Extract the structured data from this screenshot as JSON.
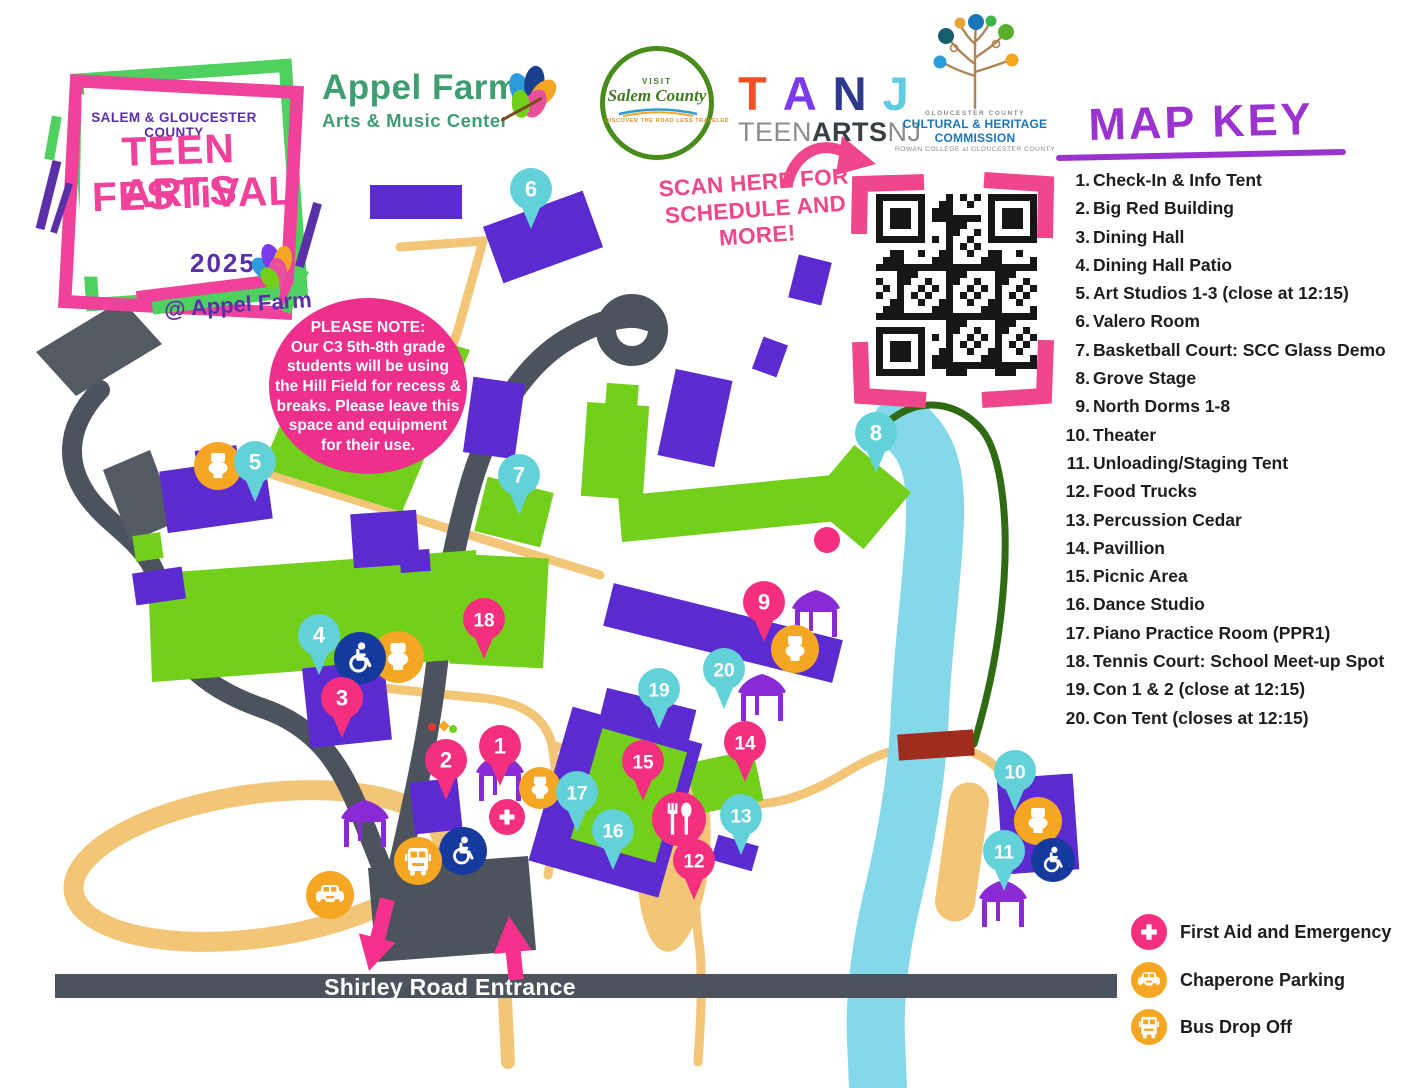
{
  "festival_logo": {
    "county_line": "SALEM & GLOUCESTER  COUNTY",
    "title_line1": "TEEN ARTS",
    "title_line2": "FESTiVAL",
    "year": "2025",
    "venue": "@ Appel Farm"
  },
  "logos": {
    "appel": {
      "name": "Appel Farm",
      "sub": "Arts & Music Center"
    },
    "salem": {
      "visit": "VISIT",
      "name": "Salem County",
      "tagline": "DISCOVER THE ROAD LESS TRAVELED"
    },
    "tanj": {
      "letters": [
        {
          "ch": "T",
          "color": "#f05123"
        },
        {
          "ch": "A",
          "color": "#7c3aed"
        },
        {
          "ch": "N",
          "color": "#2d3a8c"
        },
        {
          "ch": "J",
          "color": "#62cbe0"
        }
      ],
      "sub_teen": "TEEN",
      "sub_arts": "ARTS",
      "sub_nj": "NJ"
    },
    "chc": {
      "county": "GLOUCESTER   COUNTY",
      "line1": "CULTURAL & HERITAGE",
      "line2": "COMMISSION",
      "line3": "ROWAN COLLEGE at GLOUCESTER COUNTY"
    }
  },
  "scan": {
    "line1": "SCAN HERE FOR",
    "line2": "SCHEDULE AND MORE!"
  },
  "note": {
    "lines": [
      "PLEASE NOTE:",
      "Our C3 5th-8th grade",
      "students will be using",
      "the Hill Field for recess &",
      "breaks. Please leave this",
      "space and equipment",
      "for their use."
    ]
  },
  "road_label": "Shirley Road Entrance",
  "map_key": {
    "title": "MAP KEY",
    "items": [
      {
        "num": "1.",
        "label": "Check-In & Info Tent"
      },
      {
        "num": "2.",
        "label": "Big Red Building"
      },
      {
        "num": "3.",
        "label": "Dining Hall"
      },
      {
        "num": "4.",
        "label": "Dining Hall Patio"
      },
      {
        "num": "5.",
        "label": "Art Studios 1-3 (close at 12:15)"
      },
      {
        "num": "6.",
        "label": "Valero Room"
      },
      {
        "num": "7.",
        "label": "Basketball Court: SCC Glass Demo"
      },
      {
        "num": "8.",
        "label": "Grove Stage"
      },
      {
        "num": "9.",
        "label": "North Dorms 1-8"
      },
      {
        "num": "10.",
        "label": "Theater"
      },
      {
        "num": "11.",
        "label": "Unloading/Staging Tent"
      },
      {
        "num": "12.",
        "label": "Food Trucks"
      },
      {
        "num": "13.",
        "label": "Percussion Cedar"
      },
      {
        "num": "14.",
        "label": "Pavillion"
      },
      {
        "num": "15.",
        "label": "Picnic Area"
      },
      {
        "num": "16.",
        "label": "Dance Studio"
      },
      {
        "num": "17.",
        "label": "Piano Practice Room (PPR1)"
      },
      {
        "num": "18.",
        "label": "Tennis Court: School Meet-up Spot"
      },
      {
        "num": "19.",
        "label": "Con 1 & 2 (close at 12:15)"
      },
      {
        "num": "20.",
        "label": "Con Tent (closes at 12:15)"
      }
    ]
  },
  "legend": [
    {
      "icon": "firstaid",
      "color": "#f4307e",
      "label": "First Aid and Emergency"
    },
    {
      "icon": "car",
      "color": "#f5a623",
      "label": "Chaperone Parking"
    },
    {
      "icon": "bus",
      "color": "#f5a623",
      "label": "Bus Drop Off"
    }
  ],
  "colors": {
    "purple": "#5b2ad0",
    "green": "#72d01a",
    "cyan": "#62d2d8",
    "pink": "#f4307e",
    "orange": "#f5a623",
    "navy": "#16399e",
    "tan": "#f2c577",
    "road": "#4d535c",
    "river": "#85d8e9",
    "trail": "#2e6b12",
    "bridge": "#a02c1c",
    "tent": "#8a2ad4",
    "key_purple": "#9a33cf",
    "brand_pink": "#f0419b",
    "brand_purple": "#5b2fa8",
    "appel_green": "#3f9e71",
    "scan_pink": "#f0468c"
  },
  "markers": [
    {
      "n": "1",
      "c": "pink",
      "x": 500,
      "y": 746
    },
    {
      "n": "2",
      "c": "pink",
      "x": 446,
      "y": 760
    },
    {
      "n": "3",
      "c": "pink",
      "x": 342,
      "y": 698
    },
    {
      "n": "4",
      "c": "cyan",
      "x": 319,
      "y": 635
    },
    {
      "n": "5",
      "c": "cyan",
      "x": 255,
      "y": 462
    },
    {
      "n": "6",
      "c": "cyan",
      "x": 531,
      "y": 189
    },
    {
      "n": "7",
      "c": "cyan",
      "x": 519,
      "y": 475
    },
    {
      "n": "8",
      "c": "cyan",
      "x": 876,
      "y": 433
    },
    {
      "n": "9",
      "c": "pink",
      "x": 764,
      "y": 602
    },
    {
      "n": "10",
      "c": "cyan",
      "x": 1015,
      "y": 771
    },
    {
      "n": "11",
      "c": "cyan",
      "x": 1004,
      "y": 851
    },
    {
      "n": "12",
      "c": "pink",
      "x": 694,
      "y": 860
    },
    {
      "n": "13",
      "c": "cyan",
      "x": 741,
      "y": 815
    },
    {
      "n": "14",
      "c": "pink",
      "x": 745,
      "y": 742
    },
    {
      "n": "15",
      "c": "pink",
      "x": 643,
      "y": 761
    },
    {
      "n": "16",
      "c": "cyan",
      "x": 613,
      "y": 830
    },
    {
      "n": "17",
      "c": "cyan",
      "x": 577,
      "y": 792
    },
    {
      "n": "18",
      "c": "pink",
      "x": 484,
      "y": 619
    },
    {
      "n": "19",
      "c": "cyan",
      "x": 659,
      "y": 689
    },
    {
      "n": "20",
      "c": "cyan",
      "x": 724,
      "y": 669
    }
  ],
  "amenity_icons": [
    {
      "t": "toilet",
      "x": 218,
      "y": 466,
      "r": 24
    },
    {
      "t": "toilet",
      "x": 398,
      "y": 657,
      "r": 26
    },
    {
      "t": "toilet",
      "x": 540,
      "y": 788,
      "r": 21
    },
    {
      "t": "toilet",
      "x": 795,
      "y": 649,
      "r": 24
    },
    {
      "t": "toilet",
      "x": 1038,
      "y": 821,
      "r": 24
    },
    {
      "t": "wheelchair",
      "x": 360,
      "y": 658,
      "r": 26
    },
    {
      "t": "wheelchair",
      "x": 463,
      "y": 851,
      "r": 24
    },
    {
      "t": "wheelchair",
      "x": 1053,
      "y": 860,
      "r": 22
    },
    {
      "t": "bus",
      "x": 418,
      "y": 861,
      "r": 24
    },
    {
      "t": "car",
      "x": 330,
      "y": 895,
      "r": 24
    },
    {
      "t": "firstaid",
      "x": 507,
      "y": 817,
      "r": 18
    },
    {
      "t": "food",
      "x": 679,
      "y": 819,
      "r": 27
    }
  ],
  "tents": [
    {
      "x": 365,
      "y": 816
    },
    {
      "x": 500,
      "y": 770
    },
    {
      "x": 762,
      "y": 690
    },
    {
      "x": 816,
      "y": 606
    },
    {
      "x": 1003,
      "y": 896
    }
  ]
}
